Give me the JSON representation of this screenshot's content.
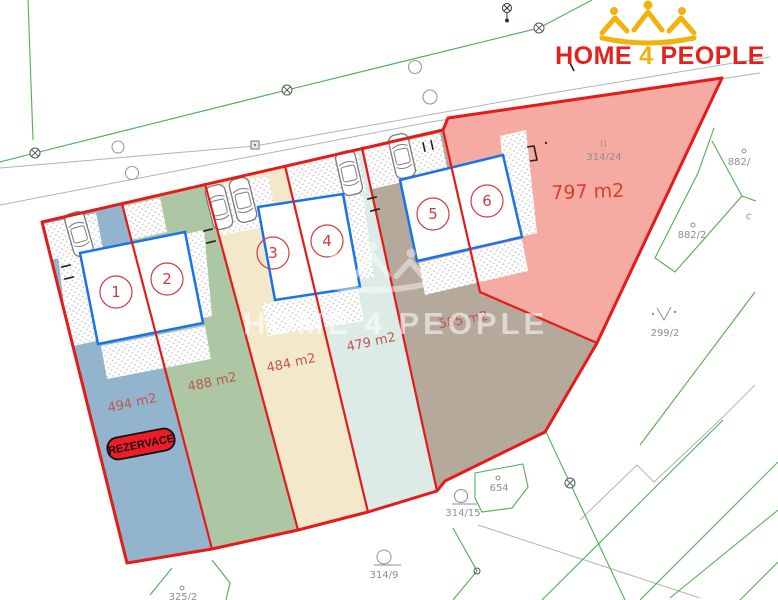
{
  "logo": {
    "word1": "HOME",
    "word2": "4",
    "word3": "PEOPLE",
    "red": "#e3211f",
    "yellow": "#f2b20d"
  },
  "watermark": {
    "text": "HOME 4 PEOPLE"
  },
  "reservation_badge": {
    "label": "REZERVACE",
    "fill": "#ee1c25"
  },
  "plots": [
    {
      "number": "1",
      "area_label": "494 m2",
      "color": "#92b5cd"
    },
    {
      "number": "2",
      "area_label": "488 m2",
      "color": "#adc6a3"
    },
    {
      "number": "3",
      "area_label": "484 m2",
      "color": "#f3e8c9"
    },
    {
      "number": "4",
      "area_label": "479 m2",
      "color": "#dcebe5"
    },
    {
      "number": "5",
      "area_label": "585 m2",
      "color": "#b4a99b"
    },
    {
      "number": "6",
      "area_label": "797 m2",
      "color": "#f5aba2"
    }
  ],
  "parcel_labels": {
    "p314_24": "314/24",
    "p314_24_mark": "II",
    "p882": "882/",
    "p882_2": "882/2",
    "p299_2": "299/2",
    "p654": "654",
    "p314_15": "314/15",
    "p314_9": "314/9",
    "p325_2": "325/2",
    "pc": "c"
  },
  "map_colors": {
    "boundary_red": "#e51a1a",
    "house_blue": "#1a73e8",
    "cadastral_green": "#4db151",
    "road_gray": "#b3b3b3",
    "label_gray": "#8f8f8f",
    "area_red": "#c05555",
    "big_area_red": "#d6402e",
    "number_red": "#d23b3b"
  }
}
